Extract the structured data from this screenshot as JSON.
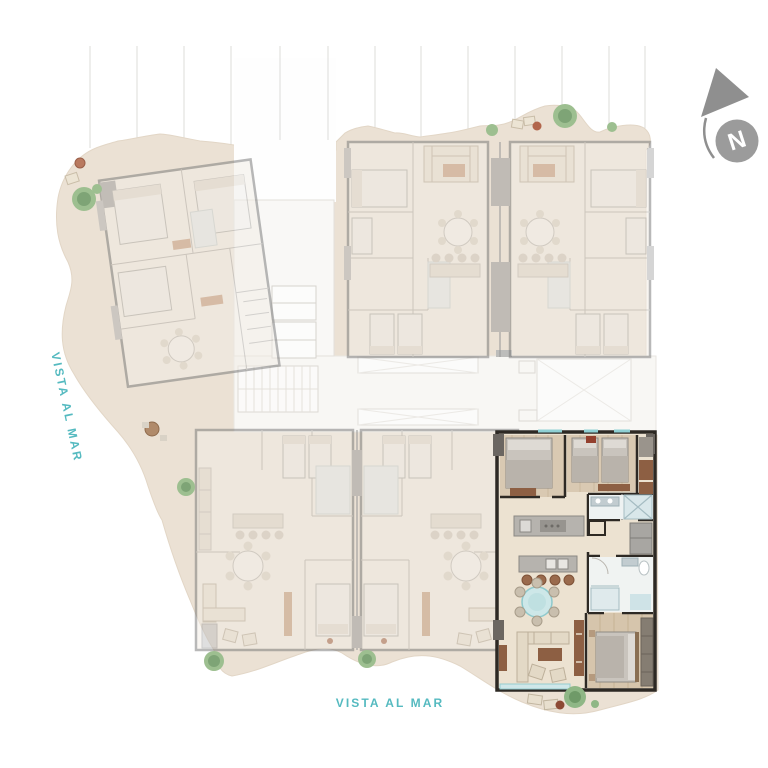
{
  "scene": {
    "type": "residential floor plate plan",
    "highlighted_unit_position": "bottom-right",
    "faded_units_count": 5
  },
  "labels": {
    "vista_left": "VISTA AL MAR",
    "vista_bottom": "VISTA AL MAR"
  },
  "compass": {
    "letter": "N"
  },
  "colors": {
    "background": "#ffffff",
    "accent_teal": "#55bac0",
    "terrace_beige": "#ebe1d4",
    "faded_plan_gray": "#9d9d9d",
    "highlight_wall": "#2d2924",
    "wood_accent": "#8d5f43",
    "plant_green": "#8fb786",
    "compass_gray": "#9a9a9a"
  }
}
